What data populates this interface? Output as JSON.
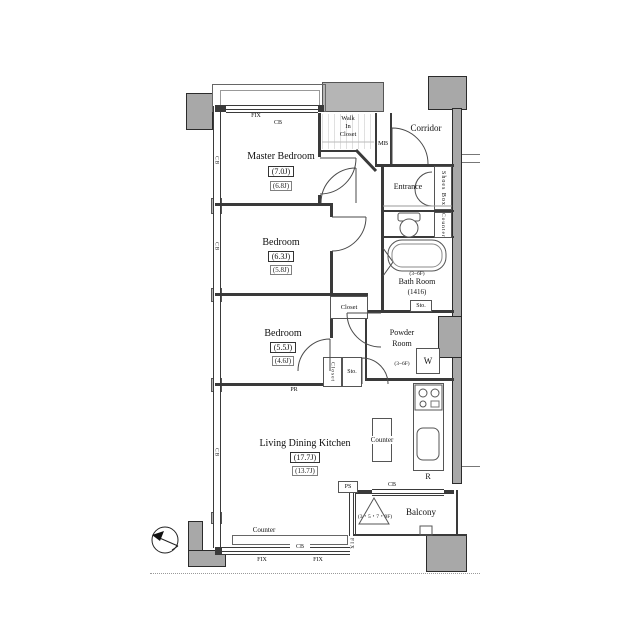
{
  "colors": {
    "structure_gray": "#a8a8a8",
    "line": "#3a3a3a"
  },
  "rooms": {
    "master": {
      "name": "Master Bedroom",
      "size": "(7.0J)",
      "size_alt": "(6.8J)"
    },
    "bedroom2": {
      "name": "Bedroom",
      "size": "(6.3J)",
      "size_alt": "(5.8J)"
    },
    "bedroom3": {
      "name": "Bedroom",
      "size": "(5.5J)",
      "size_alt": "(4.6J)"
    },
    "ldk": {
      "name": "Living Dining Kitchen",
      "size": "(17.7J)",
      "size_alt": "(13.7J)"
    },
    "corridor": {
      "name": "Corridor"
    },
    "entrance": {
      "name": "Entrance"
    },
    "bath": {
      "name": "Bath Room",
      "size": "(1416)",
      "floors": "(3~6F)"
    },
    "powder": {
      "line1": "Powder",
      "line2": "Room",
      "floors": "(3~6F)"
    },
    "wic": {
      "line1": "Walk",
      "line2": "In",
      "line3": "Closet"
    },
    "balcony": {
      "name": "Balcony",
      "floors": "(3・5・7・9F)"
    }
  },
  "fixtures": {
    "mb": "MB",
    "shoes_box": "Shoes Box",
    "counter": "Counter",
    "w": "W",
    "sto": "Sto.",
    "closet": "Closet",
    "pr": "PR",
    "ps": "PS",
    "cb": "CB",
    "fix": "FIX",
    "r": "R"
  }
}
